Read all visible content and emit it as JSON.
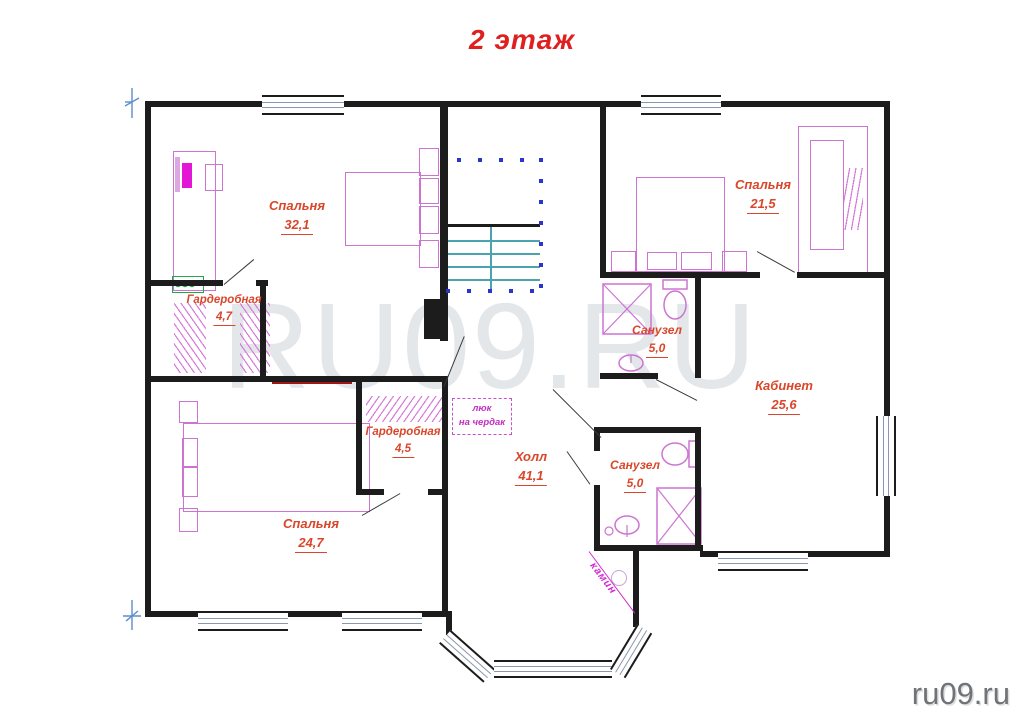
{
  "title": "2 этаж",
  "floor_plan": {
    "rooms": [
      {
        "name": "Спальня",
        "area": "32,1"
      },
      {
        "name": "Гардеробная",
        "area": "4,7"
      },
      {
        "name": "Спальня",
        "area": "24,7"
      },
      {
        "name": "Гардеробная",
        "area": "4,5"
      },
      {
        "name": "Холл",
        "area": "41,1"
      },
      {
        "name": "Спальня",
        "area": "21,5"
      },
      {
        "name": "Санузел",
        "area": "5,0"
      },
      {
        "name": "Кабинет",
        "area": "25,6"
      },
      {
        "name": "Санузел",
        "area": "5,0"
      }
    ],
    "annotations": {
      "attic_hatch_line1": "люк",
      "attic_hatch_line2": "на чердак",
      "fireplace": "камин"
    }
  },
  "watermark": "RU09.RU",
  "site_credit": "ru09.ru",
  "colors": {
    "title_red": "#e01f1f",
    "label_text": "#d9472b",
    "walls": "#1c1c1c",
    "window_lines": "#8a97ad",
    "furniture_magenta": "#cd74d2",
    "annotation_magenta": "#c32ec3",
    "stairs_teal": "#4aa3ad",
    "railing_blue": "#2a35cf",
    "radiator_green": "#1faa4a",
    "watermark_gray": "#e4e7ea"
  }
}
